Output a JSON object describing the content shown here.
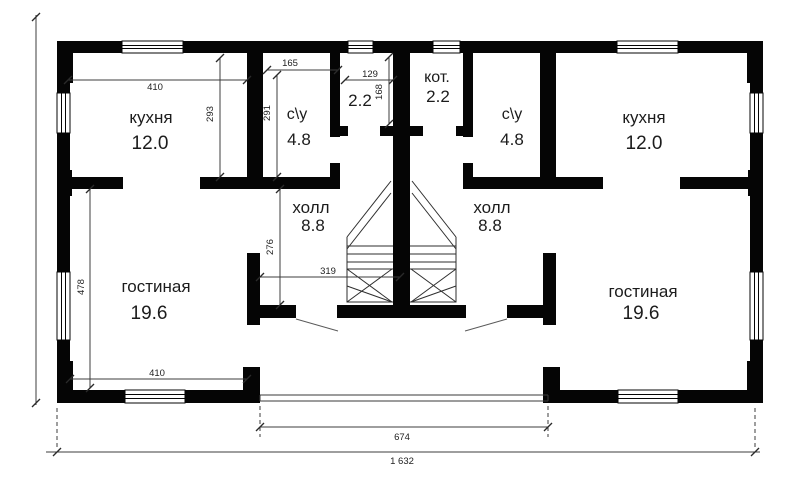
{
  "meta": {
    "type": "floor-plan",
    "language": "ru"
  },
  "rooms": {
    "kitchen_left": {
      "name": "кухня",
      "area": "12.0"
    },
    "bath_left": {
      "name": "с\\у",
      "area": "4.8"
    },
    "boiler_left": {
      "area": "2.2"
    },
    "boiler_right": {
      "name": "кот.",
      "area": "2.2"
    },
    "bath_right": {
      "name": "с\\у",
      "area": "4.8"
    },
    "kitchen_right": {
      "name": "кухня",
      "area": "12.0"
    },
    "hall_left": {
      "name": "холл",
      "area": "8.8"
    },
    "hall_right": {
      "name": "холл",
      "area": "8.8"
    },
    "living_left": {
      "name": "гостиная",
      "area": "19.6"
    },
    "living_right": {
      "name": "гостиная",
      "area": "19.6"
    }
  },
  "dimensions": {
    "kitchen_width": "410",
    "kitchen_depth": "293",
    "bath_width": "165",
    "bath_depth": "291",
    "boiler_width": "129",
    "boiler_depth": "168",
    "hall_depth": "276",
    "hall_width": "319",
    "living_depth": "478",
    "living_width": "410",
    "porch_width": "674",
    "total_width": "1 632"
  },
  "colors": {
    "wall": "#050505",
    "line": "#3c3c3c",
    "text": "#1c1c1c",
    "background": "#ffffff"
  }
}
